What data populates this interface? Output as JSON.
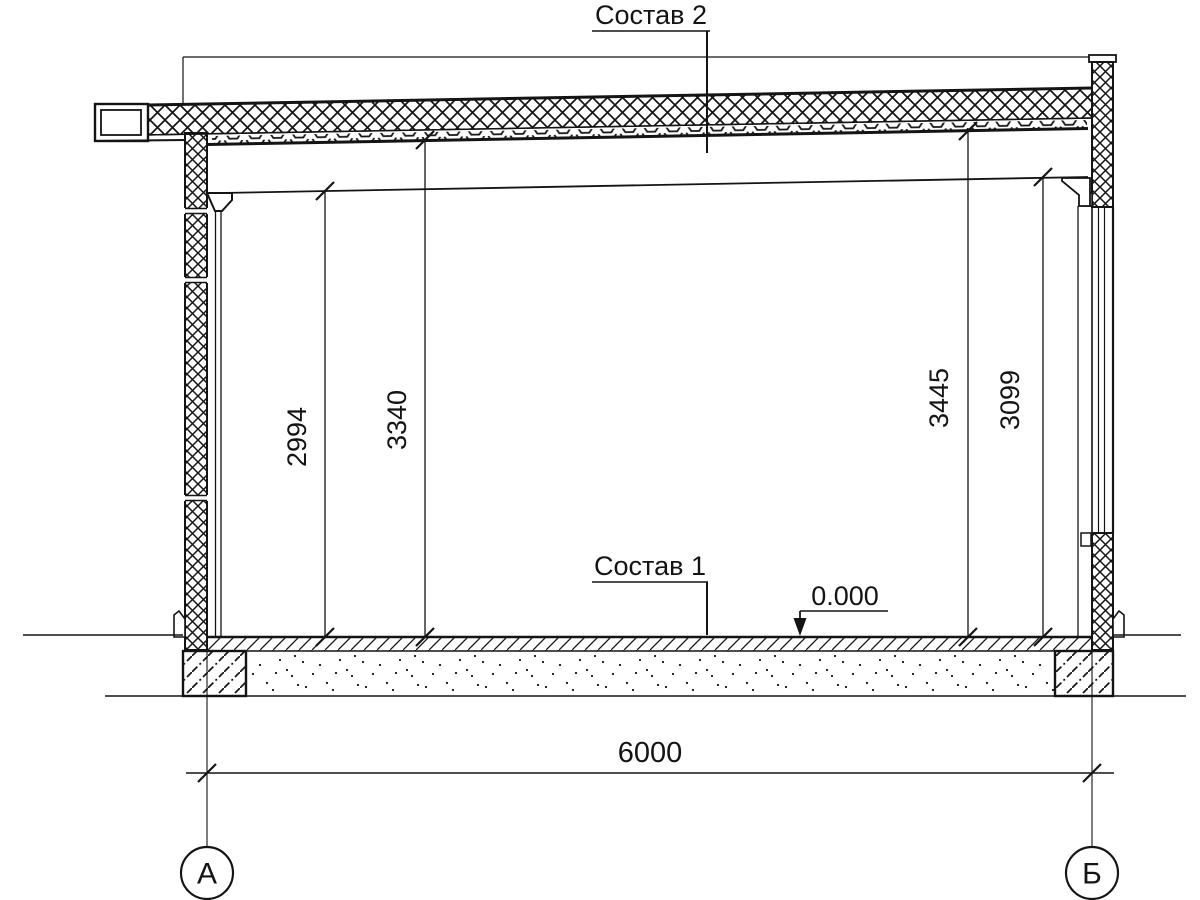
{
  "drawing": {
    "type": "building-cross-section",
    "labels": {
      "roof_composition": "Состав 2",
      "floor_composition": "Состав 1",
      "level_mark": "0.000"
    },
    "dimensions": {
      "interior_height_left": "2994",
      "exterior_height_left": "3340",
      "exterior_height_right": "3445",
      "interior_height_right": "3099",
      "span": "6000"
    },
    "axes": {
      "left": "А",
      "right": "Б"
    },
    "colors": {
      "line": "#141414",
      "background": "#ffffff"
    }
  }
}
